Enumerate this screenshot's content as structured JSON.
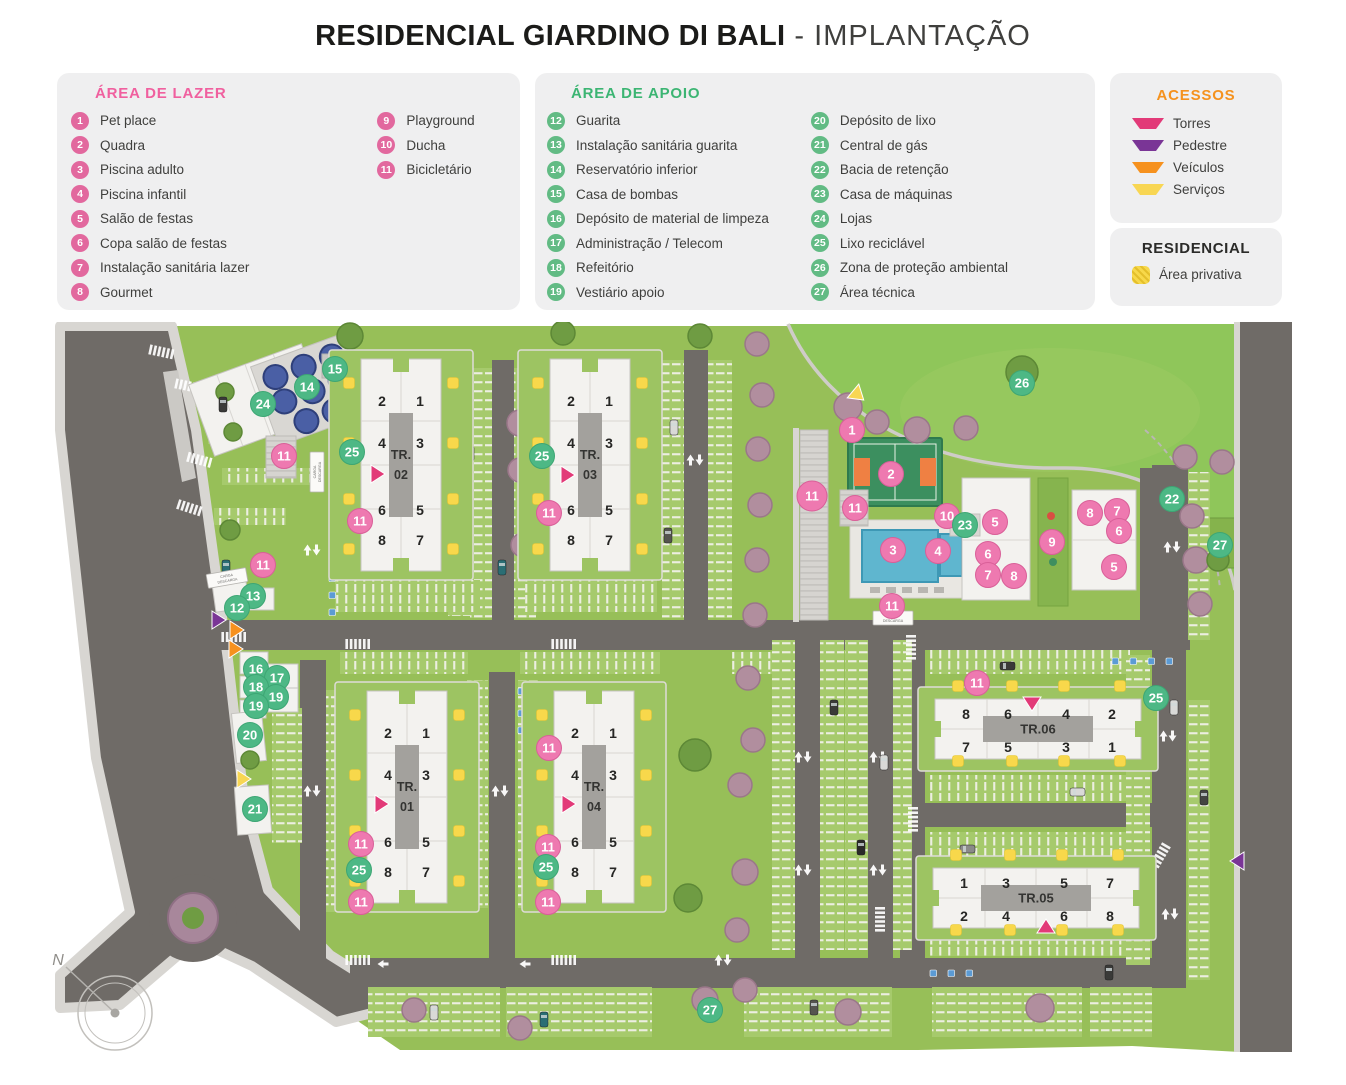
{
  "title": {
    "main": "RESIDENCIAL GIARDINO DI BALI",
    "light": "- IMPLANTAÇÃO"
  },
  "legend_lazer": {
    "title": "ÁREA DE LAZER",
    "accent": "#f0609f",
    "items": [
      {
        "num": "1",
        "label": "Pet place"
      },
      {
        "num": "2",
        "label": "Quadra"
      },
      {
        "num": "3",
        "label": "Piscina adulto"
      },
      {
        "num": "4",
        "label": "Piscina infantil"
      },
      {
        "num": "5",
        "label": "Salão de festas"
      },
      {
        "num": "6",
        "label": "Copa salão de festas"
      },
      {
        "num": "7",
        "label": "Instalação sanitária lazer"
      },
      {
        "num": "8",
        "label": "Gourmet"
      },
      {
        "num": "9",
        "label": "Playground"
      },
      {
        "num": "10",
        "label": "Ducha"
      },
      {
        "num": "11",
        "label": "Bicicletário"
      }
    ]
  },
  "legend_apoio": {
    "title": "ÁREA DE APOIO",
    "accent": "#3cb573",
    "items": [
      {
        "num": "12",
        "label": "Guarita"
      },
      {
        "num": "13",
        "label": "Instalação sanitária guarita"
      },
      {
        "num": "14",
        "label": "Reservatório inferior"
      },
      {
        "num": "15",
        "label": "Casa de bombas"
      },
      {
        "num": "16",
        "label": "Depósito de material de limpeza"
      },
      {
        "num": "17",
        "label": "Administração / Telecom"
      },
      {
        "num": "18",
        "label": "Refeitório"
      },
      {
        "num": "19",
        "label": "Vestiário apoio"
      },
      {
        "num": "20",
        "label": "Depósito de lixo"
      },
      {
        "num": "21",
        "label": "Central de gás"
      },
      {
        "num": "22",
        "label": "Bacia de retenção"
      },
      {
        "num": "23",
        "label": "Casa de máquinas"
      },
      {
        "num": "24",
        "label": "Lojas"
      },
      {
        "num": "25",
        "label": "Lixo reciclável"
      },
      {
        "num": "26",
        "label": "Zona de proteção ambiental"
      },
      {
        "num": "27",
        "label": "Área técnica"
      }
    ]
  },
  "legend_acessos": {
    "title": "ACESSOS",
    "items": [
      {
        "key": "torres",
        "label": "Torres",
        "color": "#e23a78"
      },
      {
        "key": "pedestre",
        "label": "Pedestre",
        "color": "#7a3596"
      },
      {
        "key": "veiculos",
        "label": "Veículos",
        "color": "#f6911e"
      },
      {
        "key": "servicos",
        "label": "Serviços",
        "color": "#f8d653"
      }
    ]
  },
  "legend_residencial": {
    "title": "RESIDENCIAL",
    "items": [
      {
        "label": "Área privativa",
        "color": "#f7d84a"
      }
    ]
  },
  "map": {
    "towers": [
      {
        "name": "TR. 02",
        "dir": "v",
        "cx": 401,
        "cy": 465,
        "units": [
          "2",
          "1",
          "4",
          "3",
          "6",
          "5",
          "8",
          "7"
        ]
      },
      {
        "name": "TR. 03",
        "dir": "v",
        "cx": 590,
        "cy": 465,
        "units": [
          "2",
          "1",
          "4",
          "3",
          "6",
          "5",
          "8",
          "7"
        ]
      },
      {
        "name": "TR. 01",
        "dir": "v",
        "cx": 407,
        "cy": 797,
        "units": [
          "2",
          "1",
          "4",
          "3",
          "6",
          "5",
          "8",
          "7"
        ]
      },
      {
        "name": "TR. 04",
        "dir": "v",
        "cx": 594,
        "cy": 797,
        "units": [
          "2",
          "1",
          "4",
          "3",
          "6",
          "5",
          "8",
          "7"
        ]
      },
      {
        "name": "TR.06",
        "dir": "h",
        "cx": 1038,
        "cy": 729,
        "units": [
          "8",
          "6",
          "4",
          "2",
          "7",
          "5",
          "3",
          "1"
        ]
      },
      {
        "name": "TR.05",
        "dir": "h",
        "cx": 1036,
        "cy": 898,
        "units": [
          "1",
          "3",
          "5",
          "7",
          "2",
          "4",
          "6",
          "8"
        ]
      }
    ],
    "markers": {
      "pink": "#ee79b0",
      "green": "#4db885",
      "items": [
        {
          "n": "1",
          "k": "p",
          "x": 852,
          "y": 430
        },
        {
          "n": "2",
          "k": "p",
          "x": 891,
          "y": 474
        },
        {
          "n": "3",
          "k": "p",
          "x": 893,
          "y": 550
        },
        {
          "n": "4",
          "k": "p",
          "x": 938,
          "y": 551
        },
        {
          "n": "10",
          "k": "p",
          "x": 947,
          "y": 516
        },
        {
          "n": "5",
          "k": "p",
          "x": 995,
          "y": 522
        },
        {
          "n": "6",
          "k": "p",
          "x": 988,
          "y": 554
        },
        {
          "n": "7",
          "k": "p",
          "x": 988,
          "y": 575
        },
        {
          "n": "8",
          "k": "p",
          "x": 1014,
          "y": 576
        },
        {
          "n": "9",
          "k": "p",
          "x": 1052,
          "y": 542
        },
        {
          "n": "8",
          "k": "p",
          "x": 1090,
          "y": 513
        },
        {
          "n": "7",
          "k": "p",
          "x": 1117,
          "y": 511
        },
        {
          "n": "6",
          "k": "p",
          "x": 1119,
          "y": 531
        },
        {
          "n": "5",
          "k": "p",
          "x": 1114,
          "y": 567
        },
        {
          "n": "11",
          "k": "p",
          "x": 284,
          "y": 456
        },
        {
          "n": "11",
          "k": "p",
          "x": 360,
          "y": 521
        },
        {
          "n": "11",
          "k": "p",
          "x": 263,
          "y": 565
        },
        {
          "n": "11",
          "k": "p",
          "x": 549,
          "y": 513
        },
        {
          "n": "11",
          "k": "p",
          "x": 812,
          "y": 496,
          "r": 15
        },
        {
          "n": "11",
          "k": "p",
          "x": 855,
          "y": 508
        },
        {
          "n": "11",
          "k": "p",
          "x": 892,
          "y": 606
        },
        {
          "n": "11",
          "k": "p",
          "x": 977,
          "y": 683
        },
        {
          "n": "11",
          "k": "p",
          "x": 361,
          "y": 844
        },
        {
          "n": "11",
          "k": "p",
          "x": 361,
          "y": 902
        },
        {
          "n": "11",
          "k": "p",
          "x": 549,
          "y": 748
        },
        {
          "n": "11",
          "k": "p",
          "x": 548,
          "y": 847
        },
        {
          "n": "11",
          "k": "p",
          "x": 548,
          "y": 902
        },
        {
          "n": "24",
          "k": "g",
          "x": 263,
          "y": 404
        },
        {
          "n": "14",
          "k": "g",
          "x": 307,
          "y": 387
        },
        {
          "n": "15",
          "k": "g",
          "x": 335,
          "y": 369
        },
        {
          "n": "25",
          "k": "g",
          "x": 352,
          "y": 452
        },
        {
          "n": "25",
          "k": "g",
          "x": 542,
          "y": 456
        },
        {
          "n": "26",
          "k": "g",
          "x": 1022,
          "y": 383
        },
        {
          "n": "23",
          "k": "g",
          "x": 965,
          "y": 525
        },
        {
          "n": "22",
          "k": "g",
          "x": 1172,
          "y": 499
        },
        {
          "n": "27",
          "k": "g",
          "x": 1220,
          "y": 545
        },
        {
          "n": "13",
          "k": "g",
          "x": 253,
          "y": 596
        },
        {
          "n": "12",
          "k": "g",
          "x": 237,
          "y": 608
        },
        {
          "n": "16",
          "k": "g",
          "x": 256,
          "y": 669
        },
        {
          "n": "17",
          "k": "g",
          "x": 277,
          "y": 678
        },
        {
          "n": "18",
          "k": "g",
          "x": 256,
          "y": 687
        },
        {
          "n": "19",
          "k": "g",
          "x": 276,
          "y": 697
        },
        {
          "n": "19",
          "k": "g",
          "x": 256,
          "y": 706
        },
        {
          "n": "20",
          "k": "g",
          "x": 250,
          "y": 735
        },
        {
          "n": "21",
          "k": "g",
          "x": 255,
          "y": 809
        },
        {
          "n": "25",
          "k": "g",
          "x": 359,
          "y": 870
        },
        {
          "n": "25",
          "k": "g",
          "x": 546,
          "y": 867
        },
        {
          "n": "25",
          "k": "g",
          "x": 1156,
          "y": 698
        },
        {
          "n": "27",
          "k": "g",
          "x": 710,
          "y": 1010
        }
      ]
    },
    "accesses": [
      {
        "type": "torres",
        "x": 371,
        "y": 474,
        "dir": "right"
      },
      {
        "type": "torres",
        "x": 561,
        "y": 475,
        "dir": "right"
      },
      {
        "type": "torres",
        "x": 375,
        "y": 804,
        "dir": "right"
      },
      {
        "type": "torres",
        "x": 562,
        "y": 804,
        "dir": "right"
      },
      {
        "type": "torres",
        "x": 1032,
        "y": 697,
        "dir": "down"
      },
      {
        "type": "torres",
        "x": 1046,
        "y": 933,
        "dir": "up"
      },
      {
        "type": "pedestre",
        "x": 212,
        "y": 620,
        "dir": "right"
      },
      {
        "type": "pedestre",
        "x": 1244,
        "y": 861,
        "dir": "left"
      },
      {
        "type": "veiculos",
        "x": 230,
        "y": 630,
        "dir": "right"
      },
      {
        "type": "veiculos",
        "x": 229,
        "y": 649,
        "dir": "right"
      },
      {
        "type": "servicos",
        "x": 853,
        "y": 391,
        "dir": "downright"
      },
      {
        "type": "servicos",
        "x": 237,
        "y": 779,
        "dir": "right"
      }
    ],
    "signs": [
      {
        "text": "CARGA / DESCARGA",
        "x": 227,
        "y": 578,
        "rot": -10
      },
      {
        "text": "CARGA / DESCARGA",
        "x": 317,
        "y": 472,
        "rot": -90
      },
      {
        "text": "CARGA / DESCARGA",
        "x": 893,
        "y": 618,
        "rot": 0
      }
    ],
    "compass": {
      "label": "N",
      "x": 115,
      "y": 1013
    }
  }
}
